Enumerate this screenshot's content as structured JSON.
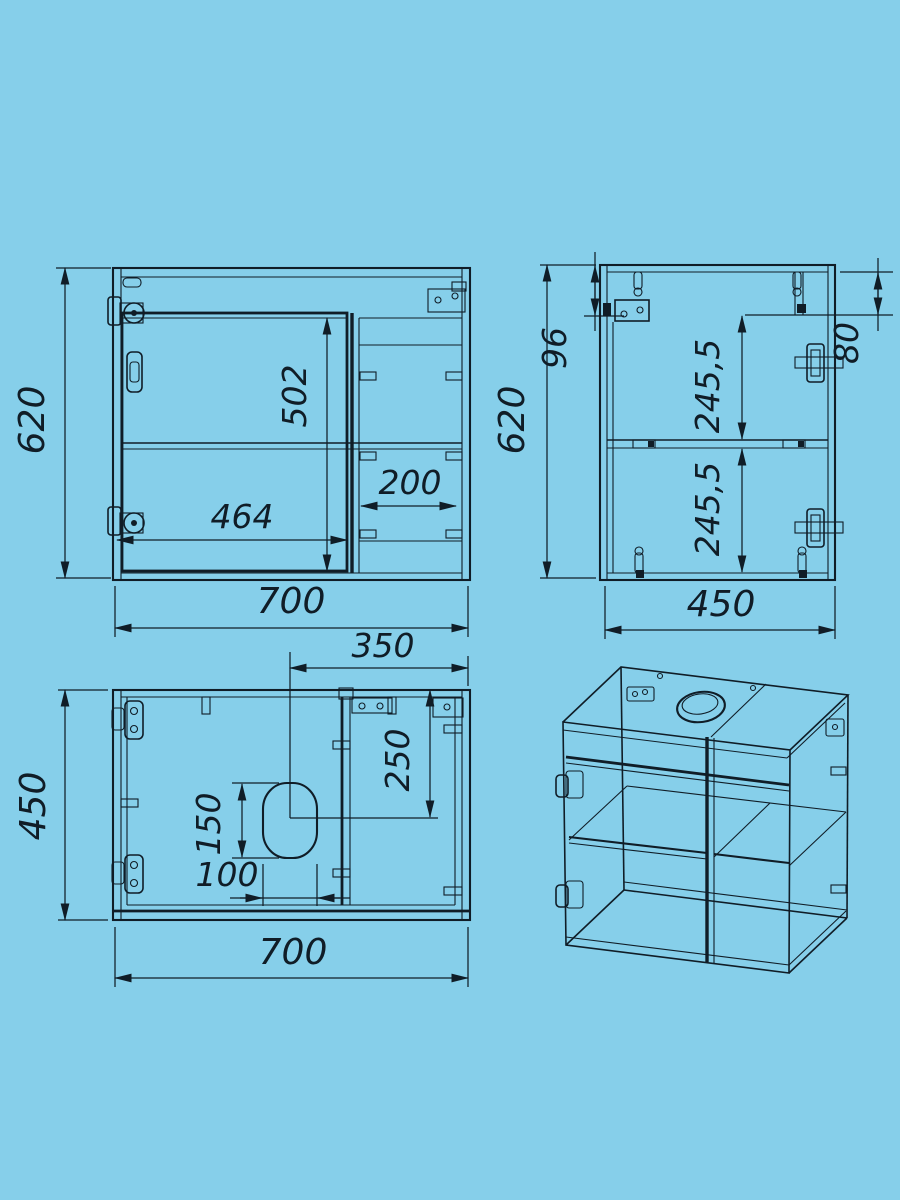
{
  "colors": {
    "background": "#86CFEA",
    "ink": "#101D27"
  },
  "views": {
    "front": {
      "dims": {
        "height": "620",
        "width": "700",
        "door_height": "502",
        "door_width": "464",
        "right_section_width": "200"
      }
    },
    "side": {
      "dims": {
        "height": "620",
        "depth": "450",
        "hanger_offset": "96",
        "top_rail_depth": "80",
        "upper_section": "245,5",
        "lower_section": "245,5"
      }
    },
    "top": {
      "dims": {
        "depth": "450",
        "width": "700",
        "hole_center_offset_x": "350",
        "hole_center_offset_y": "250",
        "hole_length": "150",
        "hole_width": "100"
      }
    }
  }
}
